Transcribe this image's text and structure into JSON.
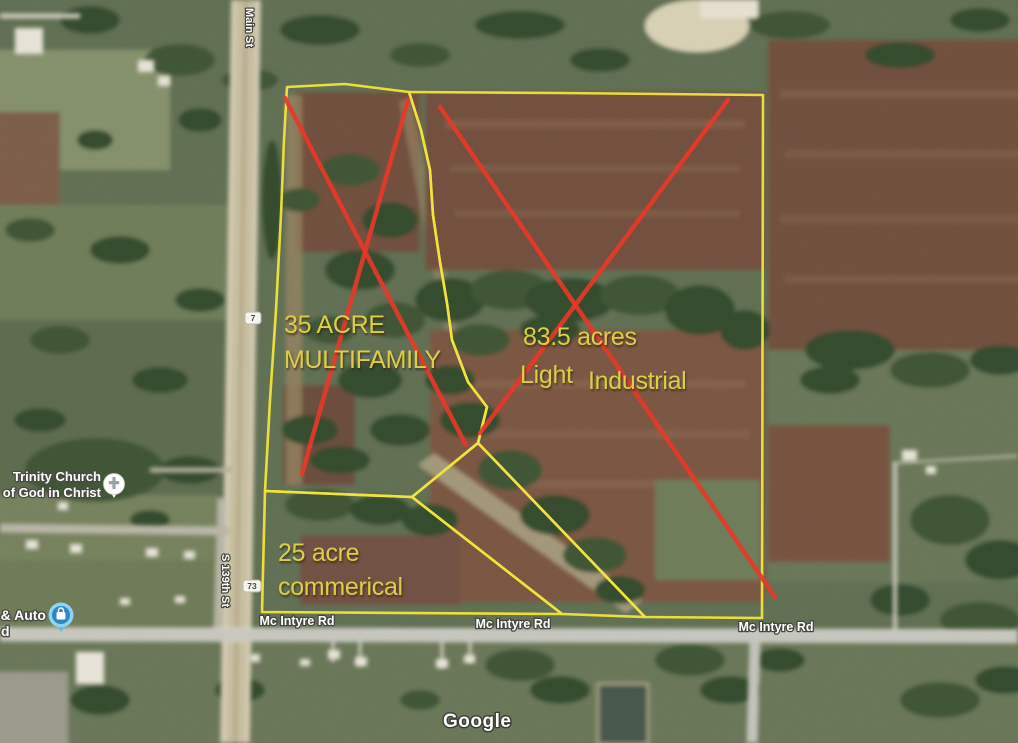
{
  "theme": {
    "parcel-outline": "#f2e33d",
    "cross-red": "#e6392a",
    "parcel-text": "#ddce49",
    "road-label": "#ffffff"
  },
  "map": {
    "attribution": "Google",
    "parcels": [
      {
        "name": "multifamily",
        "size": "35 ACRE",
        "use": "MULTIFAMILY"
      },
      {
        "name": "light-industrial",
        "size": "83.5 acres",
        "use_word1": "Light",
        "use_word2": "Industrial"
      },
      {
        "name": "commercial",
        "size": "25 acre",
        "use": "commerical"
      }
    ],
    "roads": {
      "main_st": "Main St",
      "s_139th_st": "S 139th St",
      "mcintyre_rd": "Mc Intyre Rd"
    },
    "shields": {
      "route_7": "7",
      "route_73": "73"
    },
    "pois": {
      "church_line1": "Trinity Church",
      "church_line2": "of God in Christ",
      "auto_label": "n & Auto",
      "auto_label_fragment": "d"
    }
  }
}
